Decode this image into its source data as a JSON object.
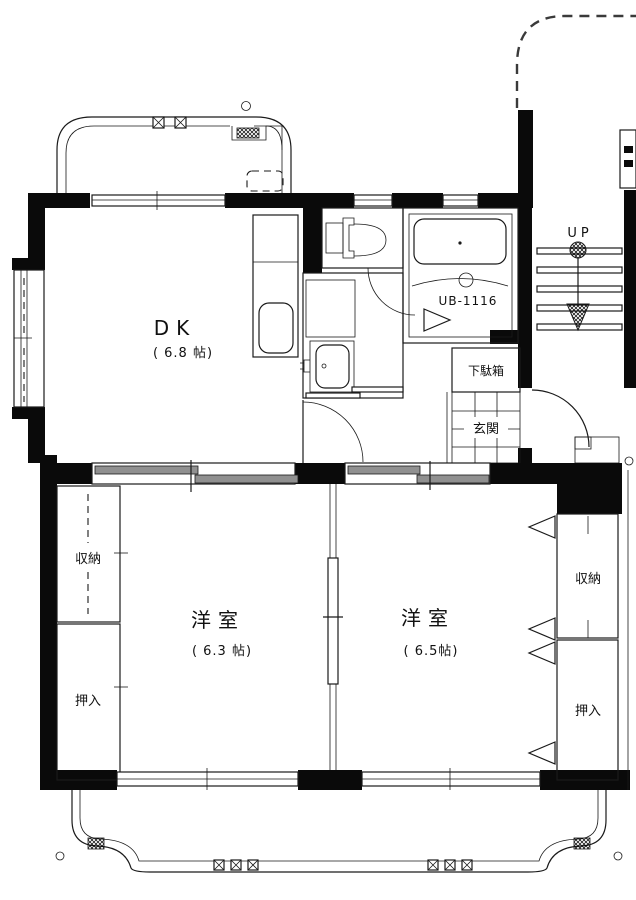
{
  "rooms": {
    "dk": {
      "label": "DK",
      "size": "( 6.8 帖)"
    },
    "bedroom_left": {
      "label": "洋室",
      "size": "( 6.3 帖)"
    },
    "bedroom_right": {
      "label": "洋室",
      "size": "( 6.5帖)"
    },
    "closet_left": {
      "label": "収納"
    },
    "oshiire_left": {
      "label": "押入"
    },
    "closet_right": {
      "label": "収納"
    },
    "oshiire_right": {
      "label": "押入"
    },
    "genkan": {
      "label": "玄関"
    },
    "getabako": {
      "label": "下駄箱"
    },
    "unit_bath": {
      "label": "UB-1116"
    }
  },
  "stairs": {
    "label": "UP"
  },
  "colors": {
    "wall": "#0a0a0a",
    "line": "#1a1a1a",
    "sliding_door_fill": "#909090",
    "background": "#ffffff"
  }
}
